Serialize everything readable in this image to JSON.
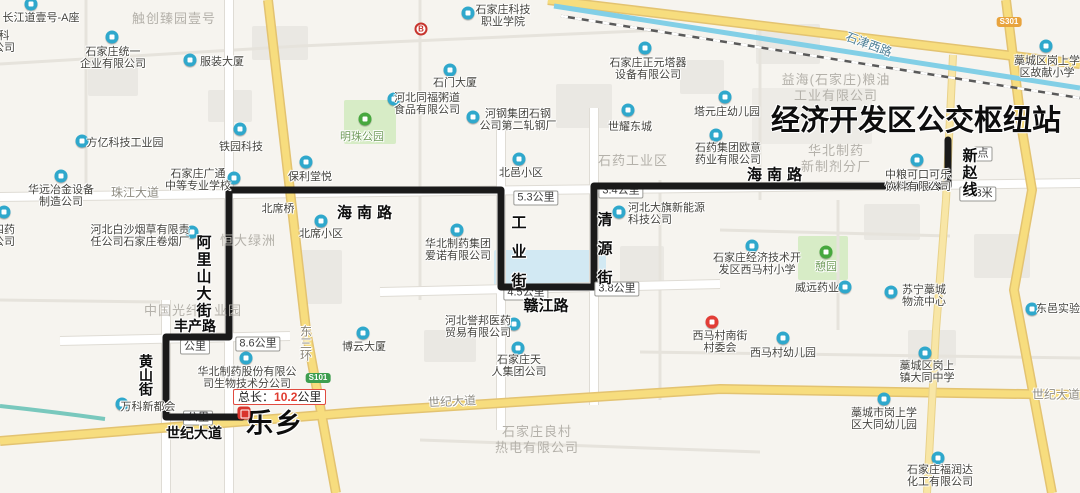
{
  "colors": {
    "route": "#1a1a1a",
    "poi_blue": "#2fa8cc",
    "poi_green": "#47a83e",
    "poi_red": "#e23d36",
    "highlight_red": "#e03c30",
    "road_yellow": "#f7dd7e",
    "water_blue": "#82cfe6"
  },
  "map": {
    "route": {
      "total_length_label": {
        "prefix": "总长：",
        "value": "10.2",
        "unit": "公里"
      },
      "start_name": "乐乡",
      "end_name": "经济开发区公交枢纽站",
      "line_name": "新赵线"
    },
    "icons": {
      "bank_letter": "B"
    },
    "street_annotations": [
      {
        "text": "经济开发区公交枢纽站",
        "x": 916,
        "y": 118,
        "size": 29,
        "ls": 0
      },
      {
        "text": "乐乡",
        "x": 275,
        "y": 421,
        "size": 27,
        "ls": 2
      },
      {
        "text": "海南路",
        "x": 367,
        "y": 212,
        "size": 15,
        "ls": 5
      },
      {
        "text": "海南路",
        "x": 777,
        "y": 174,
        "size": 15,
        "ls": 5
      },
      {
        "text": "工业街",
        "x": 518,
        "y": 258,
        "size": 15,
        "ls": 14,
        "vertical": true
      },
      {
        "text": "清源街",
        "x": 604,
        "y": 255,
        "size": 15,
        "ls": 14,
        "vertical": true
      },
      {
        "text": "赣江路",
        "x": 546,
        "y": 305,
        "size": 15,
        "ls": 0
      },
      {
        "text": "丰产路",
        "x": 195,
        "y": 326,
        "size": 14,
        "ls": 0
      },
      {
        "text": "黄山街",
        "x": 146,
        "y": 375,
        "size": 14,
        "ls": 0,
        "vertical": true
      },
      {
        "text": "阿里山大街",
        "x": 203,
        "y": 277,
        "size": 15,
        "ls": 2,
        "vertical": true
      },
      {
        "text": "世纪大道",
        "x": 194,
        "y": 433,
        "size": 14,
        "ls": 0
      },
      {
        "text": "新赵线",
        "x": 969,
        "y": 173,
        "size": 15,
        "ls": 2,
        "vertical": true
      }
    ],
    "distance_badges": [
      {
        "text": "8.6公里",
        "x": 258,
        "y": 344
      },
      {
        "text": "5.3公里",
        "x": 536,
        "y": 198
      },
      {
        "text": "3.4公里",
        "x": 621,
        "y": 191,
        "covered": true
      },
      {
        "text": "3.8公里",
        "x": 617,
        "y": 289
      },
      {
        "text": "4.5公里",
        "x": 526,
        "y": 293,
        "covered": true
      },
      {
        "text": "333米",
        "x": 978,
        "y": 194
      },
      {
        "text": "点",
        "x": 983,
        "y": 154
      },
      {
        "text": "公里",
        "x": 195,
        "y": 347,
        "covered": true
      },
      {
        "text": "公里",
        "x": 198,
        "y": 418,
        "covered": true
      }
    ],
    "shields": [
      {
        "text": "S101",
        "x": 318,
        "y": 378,
        "color": "#3d9e4f"
      },
      {
        "text": "S301",
        "x": 1009,
        "y": 22,
        "color": "#e8a33d"
      }
    ],
    "road_labels": [
      {
        "text": "珠江大道",
        "x": 135,
        "y": 192
      },
      {
        "text": "世纪大道",
        "x": 452,
        "y": 401,
        "angle": -3
      },
      {
        "text": "世纪大道",
        "x": 1056,
        "y": 394
      },
      {
        "text": "石津西路",
        "x": 869,
        "y": 44,
        "angle": 20,
        "color": "#4e7f95"
      },
      {
        "text": "东三环",
        "x": 306,
        "y": 343,
        "vertical": true,
        "color": "#8a8578"
      }
    ],
    "area_labels": [
      {
        "lines": [
          "触创臻园壹号"
        ],
        "x": 174,
        "y": 19
      },
      {
        "lines": [
          "恒大绿洲"
        ],
        "x": 248,
        "y": 241
      },
      {
        "lines": [
          "中国光纤产业园"
        ],
        "x": 193,
        "y": 311
      },
      {
        "lines": [
          "石药工业区"
        ],
        "x": 633,
        "y": 161
      },
      {
        "lines": [
          "益海(石家庄)粮油",
          "工业有限公司"
        ],
        "x": 836,
        "y": 88
      },
      {
        "lines": [
          "华北制药",
          "新制剂分厂"
        ],
        "x": 836,
        "y": 159
      },
      {
        "lines": [
          "石家庄良村",
          "热电有限公司"
        ],
        "x": 537,
        "y": 440
      }
    ],
    "pois": [
      {
        "lines": [
          "长江道壹号-A座"
        ],
        "x": 41,
        "y": 18,
        "icon": [
          31,
          4
        ]
      },
      {
        "lines": [
          "科",
          "公司"
        ],
        "x": 4,
        "y": 42
      },
      {
        "lines": [
          "石家庄统一",
          "企业有限公司"
        ],
        "x": 113,
        "y": 58,
        "icon": [
          112,
          37
        ]
      },
      {
        "lines": [
          "服装大厦"
        ],
        "x": 222,
        "y": 62,
        "icon": [
          190,
          60
        ]
      },
      {
        "lines": [
          "石家庄科技",
          "职业学院"
        ],
        "x": 503,
        "y": 16,
        "icon": [
          468,
          13
        ]
      },
      {
        "lines": [
          "石门大厦"
        ],
        "x": 455,
        "y": 83,
        "icon": [
          450,
          70
        ]
      },
      {
        "lines": [
          "河北同福粥道",
          "食品有限公司"
        ],
        "x": 427,
        "y": 104,
        "icon": [
          394,
          99
        ]
      },
      {
        "lines": [
          "河钢集团石钢",
          "公司第二轧钢厂"
        ],
        "x": 518,
        "y": 120,
        "icon": [
          473,
          117
        ]
      },
      {
        "lines": [
          "明珠公园"
        ],
        "x": 362,
        "y": 137,
        "icon": [
          365,
          119
        ],
        "type": "green",
        "green_text": true
      },
      {
        "lines": [
          "铁园科技"
        ],
        "x": 241,
        "y": 147,
        "icon": [
          240,
          129
        ]
      },
      {
        "lines": [
          "方亿科技工业园"
        ],
        "x": 125,
        "y": 143,
        "icon": [
          82,
          141
        ]
      },
      {
        "lines": [
          "石家庄正元塔器",
          "设备有限公司"
        ],
        "x": 648,
        "y": 69,
        "icon": [
          645,
          48
        ]
      },
      {
        "lines": [
          "世耀东城"
        ],
        "x": 630,
        "y": 127,
        "icon": [
          628,
          110
        ]
      },
      {
        "lines": [
          "塔元庄幼儿园"
        ],
        "x": 727,
        "y": 112,
        "icon": [
          725,
          97
        ]
      },
      {
        "lines": [
          "石药集团欧意",
          "药业有限公司"
        ],
        "x": 728,
        "y": 154,
        "icon": [
          716,
          135
        ]
      },
      {
        "lines": [
          "藁城区岗上学",
          "区故献小学"
        ],
        "x": 1047,
        "y": 67,
        "icon": [
          1046,
          46
        ]
      },
      {
        "lines": [
          "中粮可口可乐",
          "饮料有限公司"
        ],
        "x": 918,
        "y": 181,
        "icon": [
          917,
          160
        ]
      },
      {
        "lines": [
          "石家庄经济技术开",
          "发区西马村小学"
        ],
        "x": 757,
        "y": 264,
        "icon": [
          752,
          246
        ]
      },
      {
        "lines": [
          "憩园"
        ],
        "x": 826,
        "y": 267,
        "icon": [
          826,
          252
        ],
        "type": "green",
        "green_text": true
      },
      {
        "lines": [
          "威远药业"
        ],
        "x": 817,
        "y": 288,
        "icon": [
          845,
          287
        ]
      },
      {
        "lines": [
          "苏宁藁城",
          "物流中心"
        ],
        "x": 924,
        "y": 296,
        "icon": [
          891,
          292
        ]
      },
      {
        "lines": [
          "东邑实验"
        ],
        "x": 1058,
        "y": 309,
        "icon": [
          1032,
          309
        ]
      },
      {
        "lines": [
          "西马村南街",
          "村委会"
        ],
        "x": 720,
        "y": 342,
        "icon": [
          712,
          322
        ],
        "type": "red"
      },
      {
        "lines": [
          "西马村幼儿园"
        ],
        "x": 783,
        "y": 353,
        "icon": [
          783,
          338
        ]
      },
      {
        "lines": [
          "藁城区岗上",
          "镇大同中学"
        ],
        "x": 927,
        "y": 372,
        "icon": [
          925,
          353
        ]
      },
      {
        "lines": [
          "藁城市岗上学",
          "区大同幼儿园"
        ],
        "x": 884,
        "y": 419,
        "icon": [
          884,
          399
        ]
      },
      {
        "lines": [
          "石家庄福润达",
          "化工有限公司"
        ],
        "x": 940,
        "y": 476,
        "icon": [
          938,
          458
        ]
      },
      {
        "lines": [
          "博云大厦"
        ],
        "x": 364,
        "y": 347,
        "icon": [
          363,
          333
        ]
      },
      {
        "lines": [
          "石家庄天",
          "人集团公司"
        ],
        "x": 519,
        "y": 366,
        "icon": [
          518,
          348
        ]
      },
      {
        "lines": [
          "河北誉邦医药",
          "贸易有限公司"
        ],
        "x": 478,
        "y": 327,
        "icon": [
          514,
          324
        ]
      },
      {
        "lines": [
          "万科新都会"
        ],
        "x": 148,
        "y": 407,
        "icon": [
          122,
          404
        ]
      },
      {
        "lines": [
          "华北制药股份有限公",
          "司生物技术分公司"
        ],
        "x": 247,
        "y": 378,
        "icon": [
          246,
          358
        ]
      },
      {
        "lines": [
          "河北白沙烟草有限责",
          "任公司石家庄卷烟厂"
        ],
        "x": 140,
        "y": 236,
        "icon": [
          192,
          232
        ]
      },
      {
        "lines": [
          "石家庄广通",
          "中等专业学校"
        ],
        "x": 198,
        "y": 180,
        "icon": [
          234,
          178
        ]
      },
      {
        "lines": [
          "保利堂悦"
        ],
        "x": 310,
        "y": 177,
        "icon": [
          306,
          162
        ]
      },
      {
        "lines": [
          "华远冶金设备",
          "制造公司"
        ],
        "x": 61,
        "y": 196,
        "icon": [
          61,
          176
        ]
      },
      {
        "lines": [
          "四药",
          "公司"
        ],
        "x": 4,
        "y": 236,
        "icon": [
          4,
          212
        ]
      },
      {
        "lines": [
          "北席桥"
        ],
        "x": 278,
        "y": 209
      },
      {
        "lines": [
          "北席小区"
        ],
        "x": 321,
        "y": 234,
        "icon": [
          321,
          221
        ]
      },
      {
        "lines": [
          "北邑小区"
        ],
        "x": 521,
        "y": 173,
        "icon": [
          519,
          159
        ]
      },
      {
        "lines": [
          "河北大旗新能源",
          "科技公司"
        ],
        "x": 628,
        "y": 214,
        "icon": [
          619,
          212
        ],
        "align": "left"
      },
      {
        "lines": [
          "华北制药集团",
          "爱诺有限公司"
        ],
        "x": 458,
        "y": 250,
        "icon": [
          457,
          230
        ]
      }
    ]
  }
}
